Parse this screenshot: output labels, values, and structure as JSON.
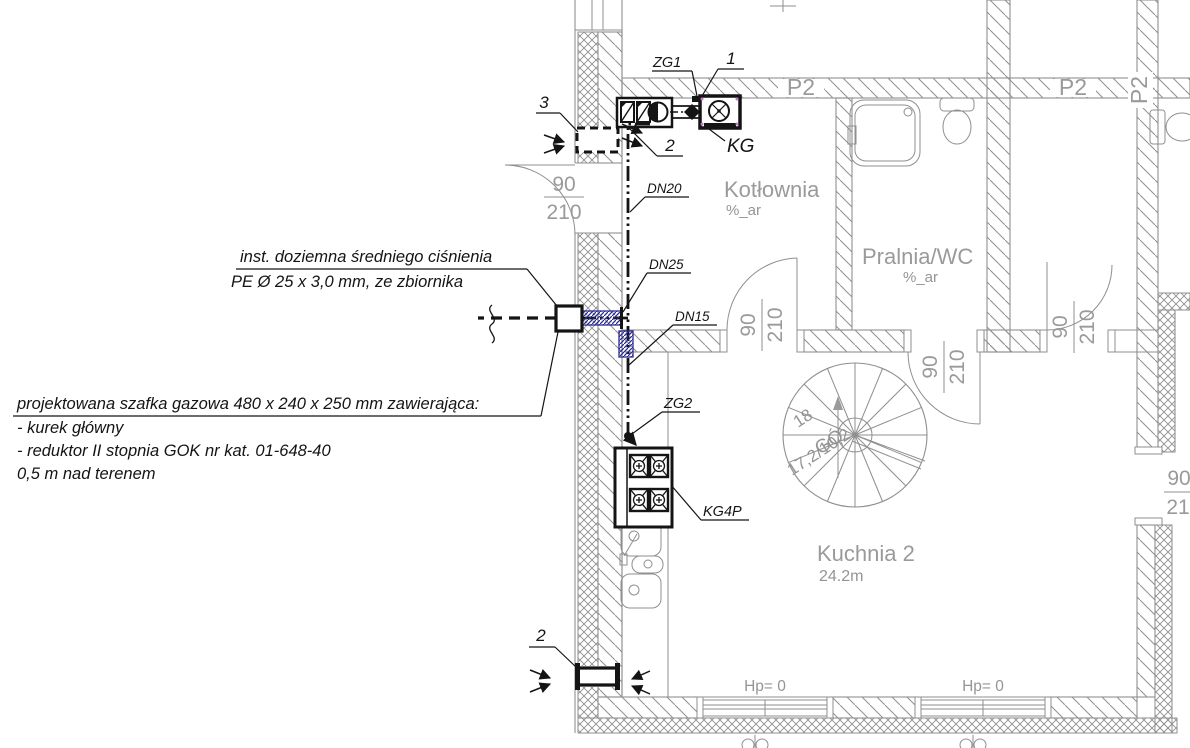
{
  "drawing": {
    "callouts": {
      "one": "1",
      "two_top": "2",
      "two_bottom": "2",
      "three": "3"
    },
    "gas": {
      "zg1": "ZG1",
      "zg2": "ZG2",
      "kg": "KG",
      "kg4p": "KG4P",
      "dn20": "DN20",
      "dn25": "DN25",
      "dn15": "DN15"
    },
    "beams": {
      "p2_a": "P2",
      "p2_b": "P2",
      "p2_rot": "P2"
    },
    "rooms": {
      "kotlownia": {
        "name": "Kotłownia",
        "area": "%_ar"
      },
      "pralnia": {
        "name": "Pralnia/WC",
        "area": "%_ar"
      },
      "kuchnia": {
        "name": "Kuchnia 2",
        "area": "24.2m"
      }
    },
    "doors": {
      "dim_num": "90",
      "dim_den": "210",
      "right_num": "90",
      "right_den": "21"
    },
    "levels": {
      "hp_a": "Hp= 0",
      "hp_b": "Hp= 0"
    },
    "stair": {
      "steps": "18",
      "up": "GÓ",
      "dims": "17,2/10,2"
    },
    "notes": {
      "underground1": "inst. doziemna średniego ciśnienia",
      "underground2": "PE Ø 25 x 3,0 mm, ze zbiornika",
      "cabinet1": "projektowana szafka gazowa 480 x 240 x 250 mm zawierająca:",
      "cabinet2": "- kurek główny",
      "cabinet3": "- reduktor II stopnia GOK nr kat. 01-648-40",
      "cabinet4": "0,5 m nad terenem"
    }
  },
  "colors": {
    "architecture": "#8f8f8f",
    "annotation": "#141414",
    "sleeve_blue": "#2a2a96"
  }
}
